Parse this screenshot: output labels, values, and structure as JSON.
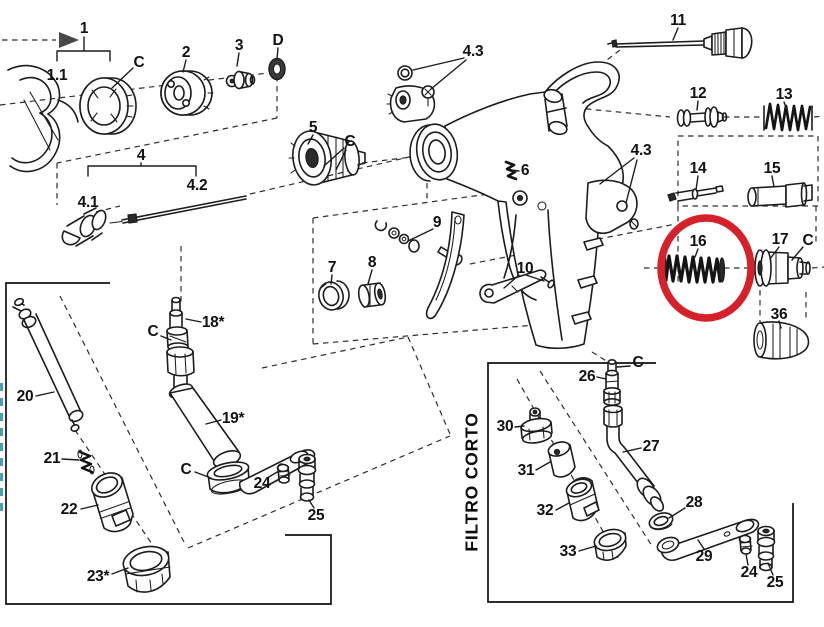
{
  "diagram": {
    "type": "exploded-parts-diagram",
    "subject": "paint spray gun exploded parts view",
    "background_color": "#ffffff",
    "line_color": "#1c1c1c",
    "highlight_circle": {
      "color": "#d7212a",
      "cx": 706,
      "cy": 268,
      "rx": 45,
      "ry": 50,
      "stroke_width": 7.5,
      "highlights_part": "16"
    },
    "direction_arrow": {
      "color": "#484848",
      "points_to": "part-1"
    },
    "section_labels": [
      {
        "id": "filtro-corto",
        "text": "FILTRO CORTO",
        "orientation": "vertical-bottom-to-top",
        "x": 472,
        "y": 482,
        "color": "#0d0d0d"
      }
    ],
    "left_margin_fragment": {
      "note": "vertical text cropped at left image edge",
      "color": "#4a9db3"
    },
    "part_labels": [
      {
        "id": "1",
        "text": "1",
        "x": 84,
        "y": 29
      },
      {
        "id": "1-1",
        "text": "1.1",
        "x": 57,
        "y": 76
      },
      {
        "id": "c-ring",
        "text": "C",
        "x": 139,
        "y": 63
      },
      {
        "id": "2",
        "text": "2",
        "x": 186,
        "y": 53
      },
      {
        "id": "3",
        "text": "3",
        "x": 239,
        "y": 46
      },
      {
        "id": "d",
        "text": "D",
        "x": 278,
        "y": 41
      },
      {
        "id": "4",
        "text": "4",
        "x": 141,
        "y": 156
      },
      {
        "id": "4-1",
        "text": "4.1",
        "x": 88,
        "y": 203
      },
      {
        "id": "4-2",
        "text": "4.2",
        "x": 197,
        "y": 186
      },
      {
        "id": "5",
        "text": "5",
        "x": 313,
        "y": 128
      },
      {
        "id": "c-knob",
        "text": "C",
        "x": 350,
        "y": 142
      },
      {
        "id": "4-3-top",
        "text": "4.3",
        "x": 473,
        "y": 52
      },
      {
        "id": "6",
        "text": "6",
        "x": 525,
        "y": 171
      },
      {
        "id": "7",
        "text": "7",
        "x": 332,
        "y": 268
      },
      {
        "id": "8",
        "text": "8",
        "x": 372,
        "y": 263
      },
      {
        "id": "9",
        "text": "9",
        "x": 437,
        "y": 223
      },
      {
        "id": "10",
        "text": "10",
        "x": 525,
        "y": 269
      },
      {
        "id": "11",
        "text": "11",
        "x": 678,
        "y": 21
      },
      {
        "id": "12",
        "text": "12",
        "x": 698,
        "y": 94
      },
      {
        "id": "13",
        "text": "13",
        "x": 784,
        "y": 95
      },
      {
        "id": "4-3-side",
        "text": "4.3",
        "x": 641,
        "y": 151
      },
      {
        "id": "14",
        "text": "14",
        "x": 698,
        "y": 169
      },
      {
        "id": "15",
        "text": "15",
        "x": 772,
        "y": 169
      },
      {
        "id": "16",
        "text": "16",
        "x": 698,
        "y": 242
      },
      {
        "id": "17",
        "text": "17",
        "x": 780,
        "y": 240
      },
      {
        "id": "c-17",
        "text": "C",
        "x": 808,
        "y": 241
      },
      {
        "id": "36",
        "text": "36",
        "x": 779,
        "y": 315
      },
      {
        "id": "c-18",
        "text": "C",
        "x": 153,
        "y": 332
      },
      {
        "id": "18",
        "text": "18*",
        "x": 213,
        "y": 323
      },
      {
        "id": "19",
        "text": "19*",
        "x": 233,
        "y": 419
      },
      {
        "id": "c-19",
        "text": "C",
        "x": 186,
        "y": 470
      },
      {
        "id": "24-left",
        "text": "24",
        "x": 262,
        "y": 484
      },
      {
        "id": "25-left",
        "text": "25",
        "x": 316,
        "y": 516
      },
      {
        "id": "20",
        "text": "20",
        "x": 25,
        "y": 397
      },
      {
        "id": "21",
        "text": "21",
        "x": 52,
        "y": 459
      },
      {
        "id": "22",
        "text": "22",
        "x": 69,
        "y": 510
      },
      {
        "id": "23",
        "text": "23*",
        "x": 98,
        "y": 577
      },
      {
        "id": "26",
        "text": "26",
        "x": 587,
        "y": 377
      },
      {
        "id": "c-26",
        "text": "C",
        "x": 638,
        "y": 363
      },
      {
        "id": "30",
        "text": "30",
        "x": 505,
        "y": 427
      },
      {
        "id": "31",
        "text": "31",
        "x": 526,
        "y": 471
      },
      {
        "id": "32",
        "text": "32",
        "x": 545,
        "y": 511
      },
      {
        "id": "33",
        "text": "33",
        "x": 568,
        "y": 552
      },
      {
        "id": "27",
        "text": "27",
        "x": 651,
        "y": 447
      },
      {
        "id": "28",
        "text": "28",
        "x": 694,
        "y": 503
      },
      {
        "id": "29",
        "text": "29",
        "x": 704,
        "y": 557
      },
      {
        "id": "24-right",
        "text": "24",
        "x": 749,
        "y": 573
      },
      {
        "id": "25-right",
        "text": "25",
        "x": 775,
        "y": 583
      }
    ]
  }
}
